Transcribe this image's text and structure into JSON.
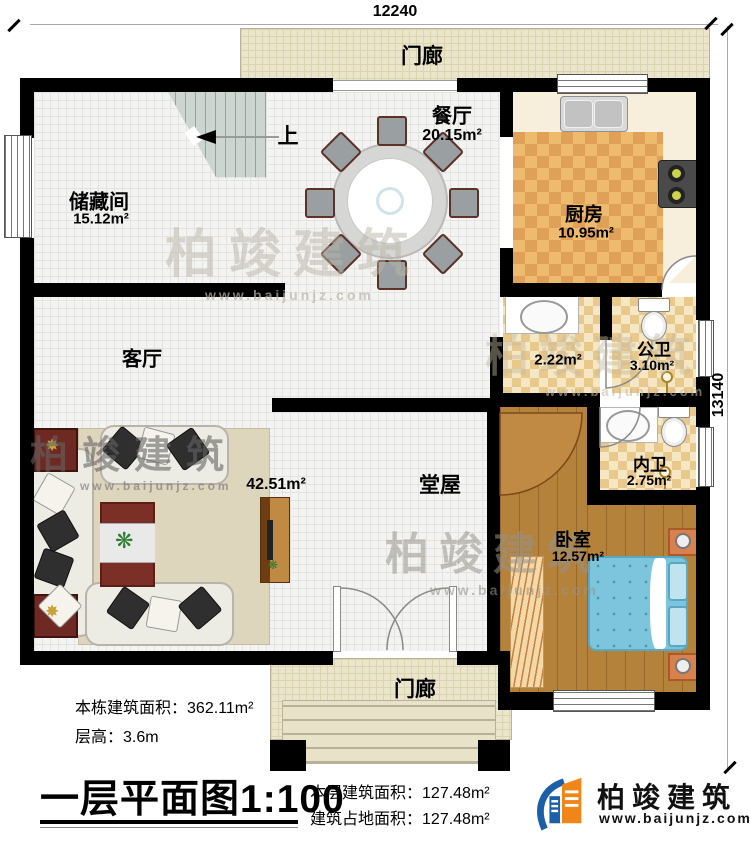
{
  "dimensions": {
    "width_label": "12240",
    "height_label": "13140"
  },
  "porch_top": {
    "label": "门廊"
  },
  "porch_bottom": {
    "label": "门廊"
  },
  "stairs": {
    "up_label": "上"
  },
  "rooms": {
    "storage": {
      "name": "储藏间",
      "area": "15.12m²"
    },
    "dining": {
      "name": "餐厅",
      "area": "20.15m²"
    },
    "kitchen": {
      "name": "厨房",
      "area": "10.95m²"
    },
    "living": {
      "name": "客厅"
    },
    "hall": {
      "name": "堂屋",
      "area": "42.51m²"
    },
    "wash": {
      "area": "2.22m²"
    },
    "public_bath": {
      "name": "公卫",
      "area": "3.10m²"
    },
    "private_bath": {
      "name": "内卫",
      "area": "2.75m²"
    },
    "bedroom": {
      "name": "卧室",
      "area": "12.57m²"
    }
  },
  "info": {
    "total_area_label": "本栋建筑面积：",
    "total_area_value": "362.11m²",
    "floor_height_label": "层高：",
    "floor_height_value": "3.6m",
    "title": "一层平面图",
    "scale": "1:100",
    "floor_area_label": "本层建筑面积：",
    "floor_area_value": "127.48m²",
    "footprint_label": "建筑占地面积：",
    "footprint_value": "127.48m²"
  },
  "brand": {
    "name": "柏竣建筑",
    "website": "www.baijunjz.com"
  },
  "watermarks": [
    {
      "text": "柏竣建筑",
      "sub": "www.baijunjz.com"
    },
    {
      "text": "柏竣建筑",
      "sub": "www.baijunjz.com"
    },
    {
      "text": "柏竣建筑",
      "sub": "www.baijunjz.com"
    },
    {
      "text": "柏竣建筑",
      "sub": "www.baijunjz.com"
    }
  ],
  "colors": {
    "wall": "#000000",
    "kitchen_checker": "#e9b469",
    "wood_floor": "#b5823c",
    "bed": "#7cc5dc",
    "brand_blue": "#1a5fa8",
    "brand_orange": "#f08519"
  }
}
